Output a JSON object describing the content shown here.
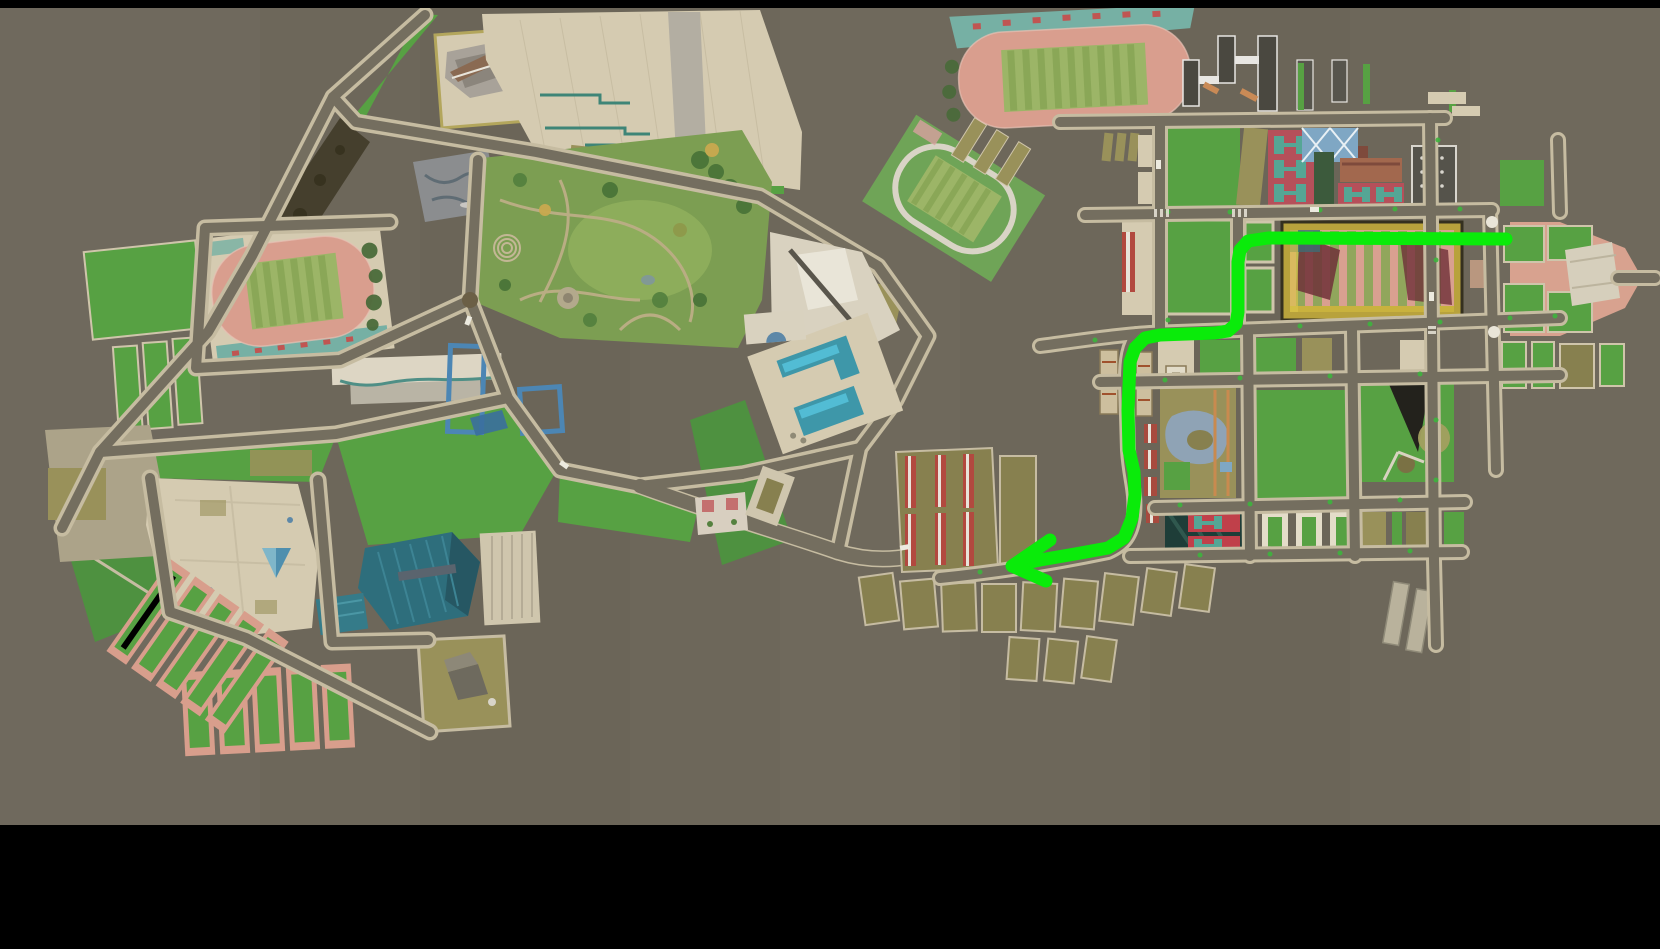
{
  "scene": {
    "description": "Aerial 3D campus map (letterboxed game/sim view) with a bright green navigation route ending in an arrow on the eastern campus",
    "width": 1660,
    "height": 949,
    "top_bar_height": 8,
    "bottom_bar_top": 825,
    "letterbox_color": "#000000"
  },
  "palette": {
    "bg": "#6d675a",
    "bgLight": "#736d5f",
    "road": "#746e5f",
    "roadCasing": "#c6bca1",
    "lawn": "#57a143",
    "lawnDark": "#4e9140",
    "parkGreen": "#7c9e52",
    "plaza": "#d5cbb1",
    "khaki": "#99915a",
    "olive": "#87804f",
    "track": "#d99e8e",
    "fieldGreen": "#9cb567",
    "fieldStripe": "#8aa757",
    "mosaic": "#76b0a4",
    "tealGym": "#2e6e7c",
    "pool": "#3e97a9",
    "water": "#52bcd4",
    "redCourt": "#b5505a",
    "courtTeal": "#55a695",
    "blueFrame": "#4c86b4",
    "darkBldg": "#4a4840",
    "white": "#e9e5d8",
    "brownBldg": "#a2684e",
    "pinkPlaza": "#d8a28f",
    "dirt": "#453f2d",
    "route": "#0AEB0A"
  },
  "route": {
    "color": "#0AEB0A",
    "width": 13,
    "points": [
      [
        1506,
        239
      ],
      [
        1268,
        238
      ],
      [
        1248,
        241
      ],
      [
        1240,
        250
      ],
      [
        1238,
        262
      ],
      [
        1238,
        312
      ],
      [
        1236,
        324
      ],
      [
        1228,
        331
      ],
      [
        1215,
        333
      ],
      [
        1160,
        335
      ],
      [
        1145,
        338
      ],
      [
        1135,
        348
      ],
      [
        1130,
        362
      ],
      [
        1128,
        410
      ],
      [
        1129,
        450
      ],
      [
        1134,
        472
      ],
      [
        1135,
        495
      ],
      [
        1132,
        518
      ],
      [
        1124,
        538
      ],
      [
        1108,
        548
      ],
      [
        1075,
        554
      ],
      [
        1040,
        560
      ],
      [
        1026,
        563
      ]
    ],
    "arrow_points": [
      [
        1050,
        540
      ],
      [
        1012,
        566
      ],
      [
        1046,
        581
      ]
    ]
  },
  "landmarks": {
    "left_campus": [
      "west-stadium",
      "central-park",
      "north-tiled-plaza",
      "angular-gray-building",
      "skate-park",
      "wooded-slope",
      "white-hall",
      "blue-frame-courts",
      "west-court-strips",
      "south-plaza-pyramid",
      "teal-gymnasium",
      "tennis-court-rows",
      "service-yard"
    ],
    "middle": [
      "diagonal-practice-field",
      "pool-building",
      "white-pavilion",
      "greenhouse-yard",
      "olive-court-rows"
    ],
    "right_campus": [
      "north-stadium",
      "dormitory-towers",
      "red-tennis-courts",
      "glass-roof-building",
      "brown-building",
      "parking-structure",
      "main-striped-field",
      "east-gate-plaza",
      "pond-garden",
      "triangle-roof-lawn",
      "court-blocks",
      "south-walkways"
    ]
  }
}
